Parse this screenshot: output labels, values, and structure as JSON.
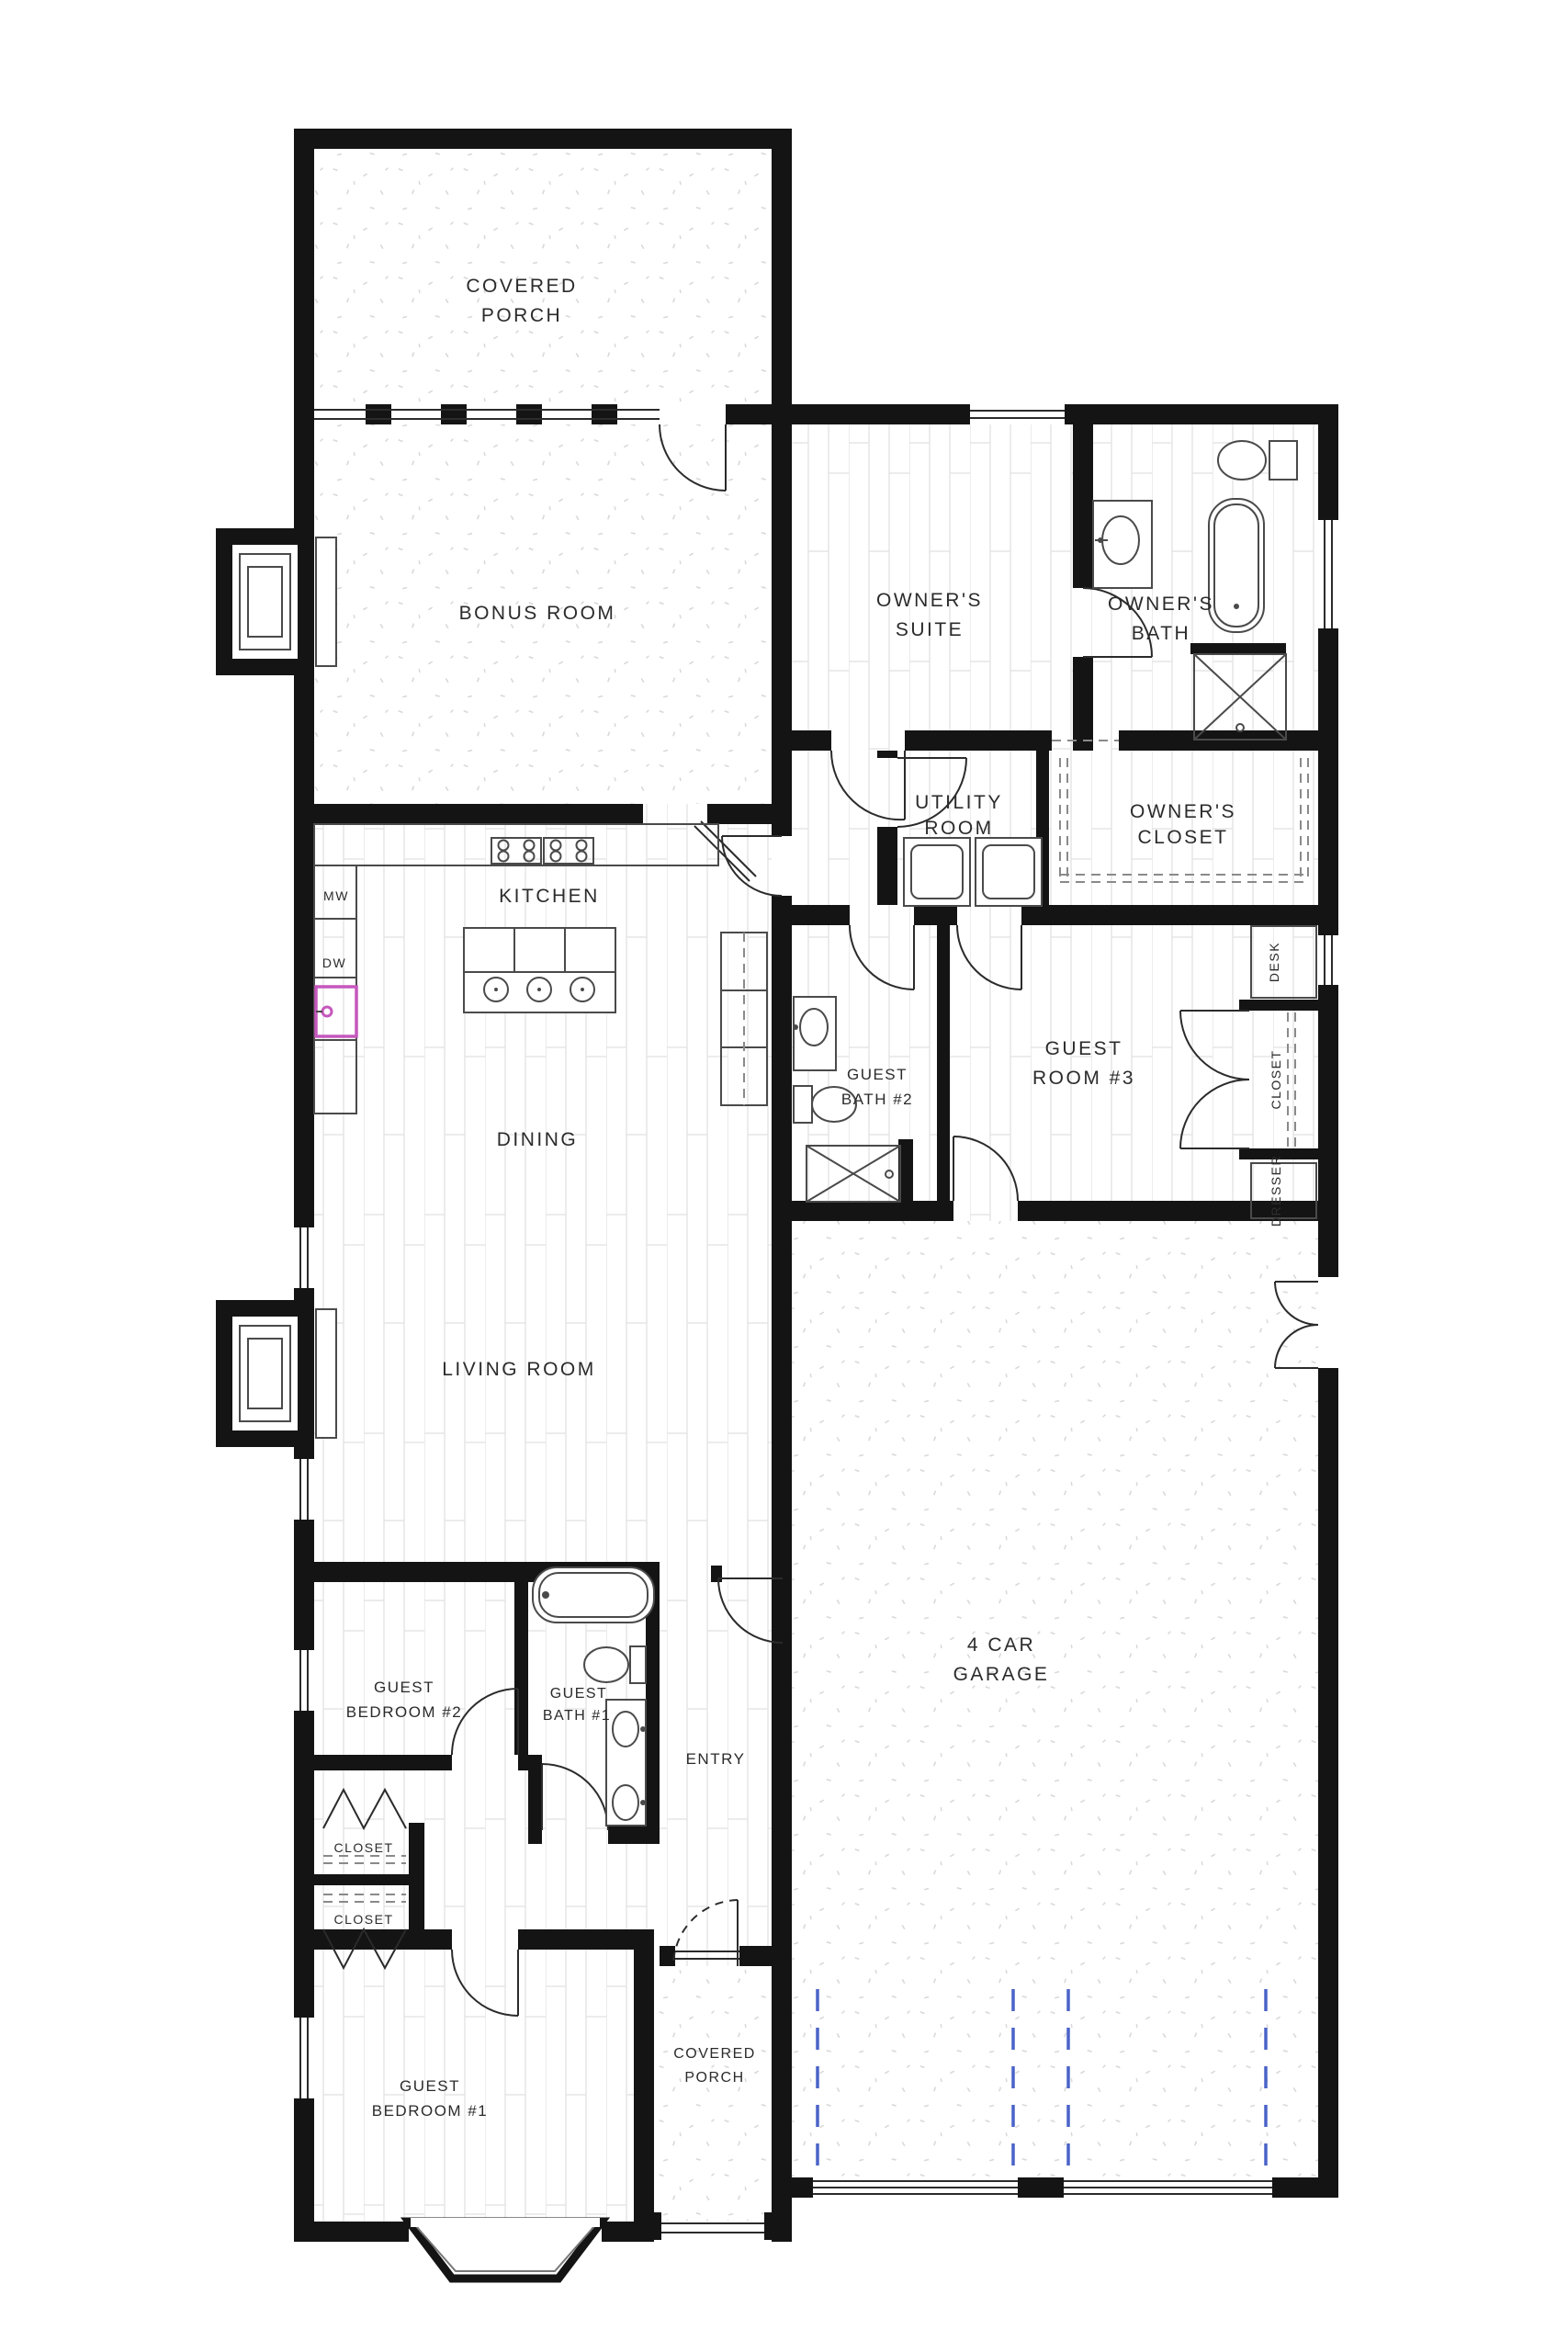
{
  "plan": {
    "type": "architectural-floor-plan",
    "colors": {
      "wall": "#141414",
      "label": "#2b2b2b",
      "fixture": "#4a4a4a",
      "floor_line": "#e2e2e2",
      "stipple": "#d9d9d9",
      "sink_highlight": "#c657bd",
      "garage_track": "#4a63c8"
    },
    "rooms": {
      "covered_porch_top": {
        "line1": "COVERED",
        "line2": "PORCH"
      },
      "bonus_room": {
        "label": "BONUS ROOM"
      },
      "owners_suite": {
        "line1": "OWNER'S",
        "line2": "SUITE"
      },
      "owners_bath": {
        "line1": "OWNER'S",
        "line2": "BATH"
      },
      "utility_room": {
        "line1": "UTILITY",
        "line2": "ROOM"
      },
      "owners_closet": {
        "line1": "OWNER'S",
        "line2": "CLOSET"
      },
      "kitchen": {
        "label": "KITCHEN"
      },
      "dining": {
        "label": "DINING"
      },
      "living_room": {
        "label": "LIVING ROOM"
      },
      "guest_bath_2": {
        "line1": "GUEST",
        "line2": "BATH #2"
      },
      "guest_room_3": {
        "line1": "GUEST",
        "line2": "ROOM #3"
      },
      "garage": {
        "line1": "4 CAR",
        "line2": "GARAGE"
      },
      "guest_bedroom_2": {
        "line1": "GUEST",
        "line2": "BEDROOM #2"
      },
      "guest_bath_1": {
        "line1": "GUEST",
        "line2": "BATH #1"
      },
      "entry": {
        "label": "ENTRY"
      },
      "closet_hall": {
        "label": "CLOSET"
      },
      "closet_bedroom": {
        "label": "CLOSET"
      },
      "guest_bedroom_1": {
        "line1": "GUEST",
        "line2": "BEDROOM #1"
      },
      "covered_porch_bottom": {
        "line1": "COVERED",
        "line2": "PORCH"
      }
    },
    "fixtures": {
      "microwave": "MW",
      "dishwasher": "DW",
      "desk": "DESK",
      "guest_room_3_closet": "CLOSET",
      "dresser": "DRESSER"
    }
  }
}
